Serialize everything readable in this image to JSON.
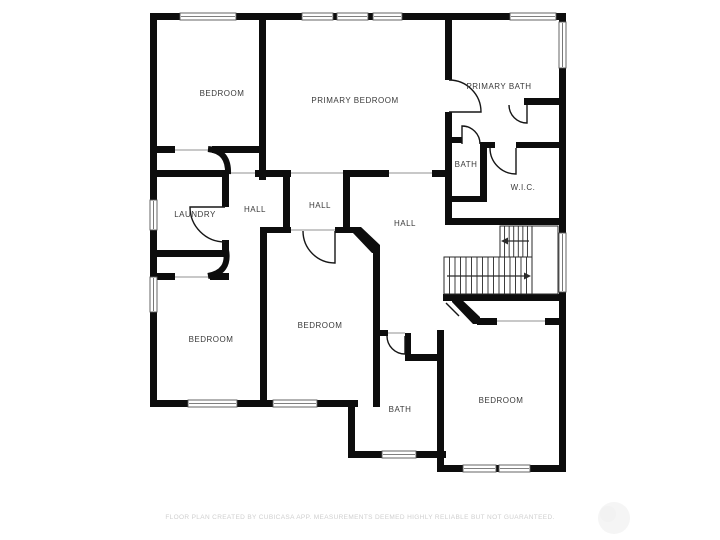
{
  "footer": {
    "disclaimer": "FLOOR PLAN CREATED BY CUBICASA APP. MEASUREMENTS DEEMED HIGHLY RELIABLE BUT NOT GUARANTEED."
  },
  "plan": {
    "colors": {
      "wall": "#0d0d0d",
      "label": "#3a3a3a",
      "opening": "#b5b5b5",
      "stair": "#2a2a2a",
      "window_frame": "#555555",
      "watermark": "#f5f5f5"
    },
    "rooms": [
      {
        "label": "BEDROOM",
        "x": 222,
        "y": 96
      },
      {
        "label": "PRIMARY BEDROOM",
        "x": 355,
        "y": 103
      },
      {
        "label": "PRIMARY BATH",
        "x": 499,
        "y": 89
      },
      {
        "label": "BATH",
        "x": 466,
        "y": 167
      },
      {
        "label": "W.I.C.",
        "x": 523,
        "y": 190
      },
      {
        "label": "LAUNDRY",
        "x": 195,
        "y": 217
      },
      {
        "label": "HALL",
        "x": 255,
        "y": 212
      },
      {
        "label": "HALL",
        "x": 320,
        "y": 208
      },
      {
        "label": "HALL",
        "x": 405,
        "y": 226
      },
      {
        "label": "BEDROOM",
        "x": 211,
        "y": 342
      },
      {
        "label": "BEDROOM",
        "x": 320,
        "y": 328
      },
      {
        "label": "BATH",
        "x": 400,
        "y": 412
      },
      {
        "label": "BEDROOM",
        "x": 501,
        "y": 403
      }
    ],
    "walls": [
      [
        150,
        13,
        416,
        7
      ],
      [
        150,
        13,
        7,
        394
      ],
      [
        559,
        13,
        7,
        459
      ],
      [
        150,
        400,
        208,
        7
      ],
      [
        348,
        400,
        7,
        58
      ],
      [
        348,
        451,
        98,
        7
      ],
      [
        437,
        465,
        129,
        7
      ],
      [
        437,
        330,
        7,
        142
      ],
      [
        259,
        13,
        7,
        167
      ],
      [
        150,
        146,
        25,
        7
      ],
      [
        212,
        146,
        54,
        7
      ],
      [
        150,
        170,
        79,
        7
      ],
      [
        222,
        177,
        7,
        30
      ],
      [
        222,
        240,
        7,
        17
      ],
      [
        150,
        250,
        79,
        7
      ],
      [
        150,
        273,
        25,
        7
      ],
      [
        210,
        273,
        19,
        7
      ],
      [
        255,
        170,
        36,
        7
      ],
      [
        343,
        170,
        46,
        7
      ],
      [
        432,
        170,
        20,
        7
      ],
      [
        283,
        170,
        7,
        63
      ],
      [
        343,
        170,
        7,
        63
      ],
      [
        260,
        227,
        31,
        6
      ],
      [
        335,
        227,
        18,
        6
      ],
      [
        260,
        227,
        7,
        180
      ],
      [
        373,
        247,
        7,
        160
      ],
      [
        373,
        330,
        15,
        6
      ],
      [
        405,
        333,
        6,
        27
      ],
      [
        405,
        354,
        39,
        7
      ],
      [
        445,
        13,
        7,
        67
      ],
      [
        445,
        112,
        7,
        113
      ],
      [
        452,
        137,
        10,
        6
      ],
      [
        480,
        142,
        7,
        60
      ],
      [
        480,
        142,
        15,
        6
      ],
      [
        445,
        196,
        42,
        6
      ],
      [
        516,
        142,
        50,
        6
      ],
      [
        524,
        98,
        42,
        7
      ],
      [
        445,
        218,
        121,
        7
      ],
      [
        443,
        294,
        123,
        7
      ],
      [
        477,
        318,
        20,
        7
      ],
      [
        545,
        318,
        21,
        7
      ]
    ],
    "diagonals": [
      "353,227 361,227 380,245 380,253 372,253 353,233",
      "452,296 458,296 480,317 480,324 473,324 452,302"
    ],
    "openings": [
      [
        229,
        173,
        255,
        173
      ],
      [
        291,
        173,
        343,
        173
      ],
      [
        389,
        173,
        432,
        173
      ],
      [
        291,
        230,
        335,
        230
      ],
      [
        175,
        277,
        210,
        277
      ],
      [
        175,
        150,
        212,
        150
      ],
      [
        497,
        321,
        545,
        321
      ],
      [
        387,
        333,
        405,
        333
      ]
    ],
    "windows": [
      [
        180,
        13,
        56,
        7
      ],
      [
        302,
        13,
        31,
        7
      ],
      [
        337,
        13,
        31,
        7
      ],
      [
        373,
        13,
        29,
        7
      ],
      [
        510,
        13,
        46,
        7
      ],
      [
        150,
        200,
        7,
        30
      ],
      [
        150,
        277,
        7,
        35
      ],
      [
        559,
        22,
        7,
        46
      ],
      [
        559,
        233,
        7,
        59
      ],
      [
        188,
        400,
        49,
        7
      ],
      [
        273,
        400,
        44,
        7
      ],
      [
        382,
        451,
        34,
        7
      ],
      [
        463,
        465,
        33,
        7
      ],
      [
        499,
        465,
        31,
        7
      ]
    ],
    "doors": [
      "M225,207 L190,207 A35,35 0 0 0 225,242",
      "M335,231 L335,263 A32,32 0 0 1 303,231",
      "M449,112 L481,112 A32,32 0 0 0 449,80",
      "M462,144 L462,126 A18,18 0 0 1 480,144",
      "M516,148 L516,174 A26,26 0 0 1 490,148",
      "M405,336 L405,354 A18,18 0 0 1 387,336",
      "M527,105 L527,123 A18,18 0 0 1 509,105",
      "M446,303 L459,316"
    ],
    "door_leaves": [
      "M208,149 Q229,151 228,174",
      "M226,250 Q230,272 208,276"
    ],
    "stairs": {
      "flights": [
        {
          "x": 500,
          "y": 226,
          "w": 32,
          "h": 31,
          "treads": 6
        },
        {
          "x": 444,
          "y": 257,
          "w": 88,
          "h": 37,
          "treads": 15
        }
      ],
      "landing": {
        "x": 532,
        "y": 226,
        "w": 26,
        "h": 68
      },
      "arrows": [
        {
          "x1": 529,
          "y1": 241,
          "x2": 506,
          "y2": 241
        },
        {
          "x1": 447,
          "y1": 276,
          "x2": 526,
          "y2": 276
        }
      ]
    },
    "watermark": {
      "cx": 614,
      "cy": 518,
      "r": 16
    }
  }
}
